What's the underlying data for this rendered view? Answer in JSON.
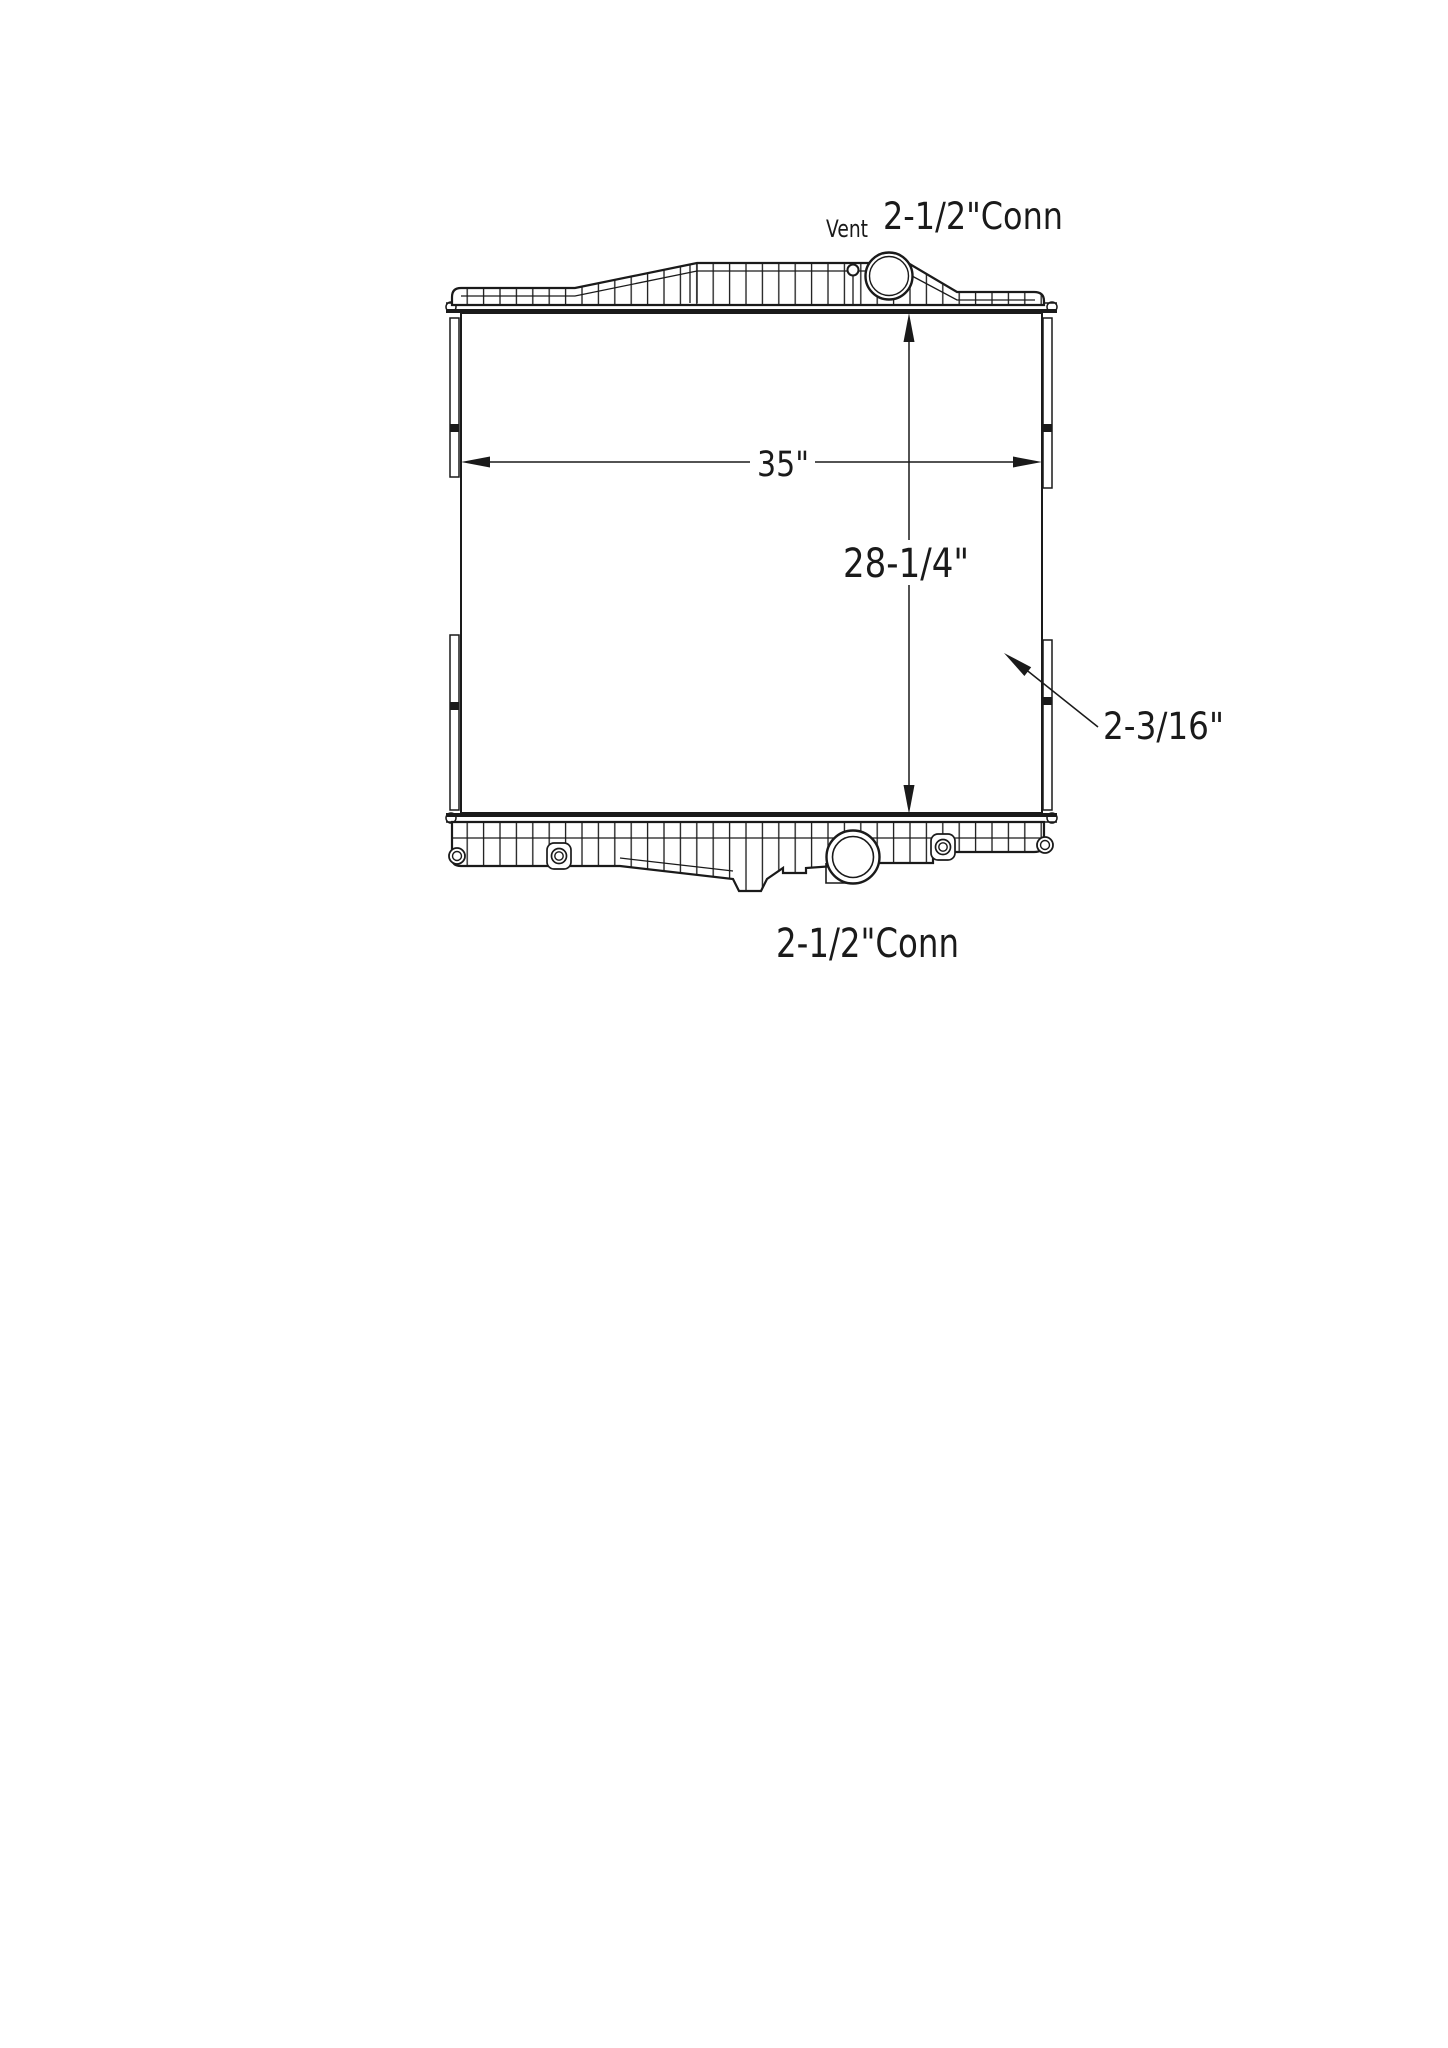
{
  "page": {
    "background_color": "#ffffff",
    "line_color": "#1a1a1a"
  },
  "drawing": {
    "labels": {
      "vent": "Vent",
      "top_connection": "2-1/2\"Conn",
      "bottom_connection": "2-1/2\"Conn"
    },
    "dimensions": {
      "core_width": "35\"",
      "core_height": "28-1/4\"",
      "core_depth": "2-3/16\""
    }
  }
}
